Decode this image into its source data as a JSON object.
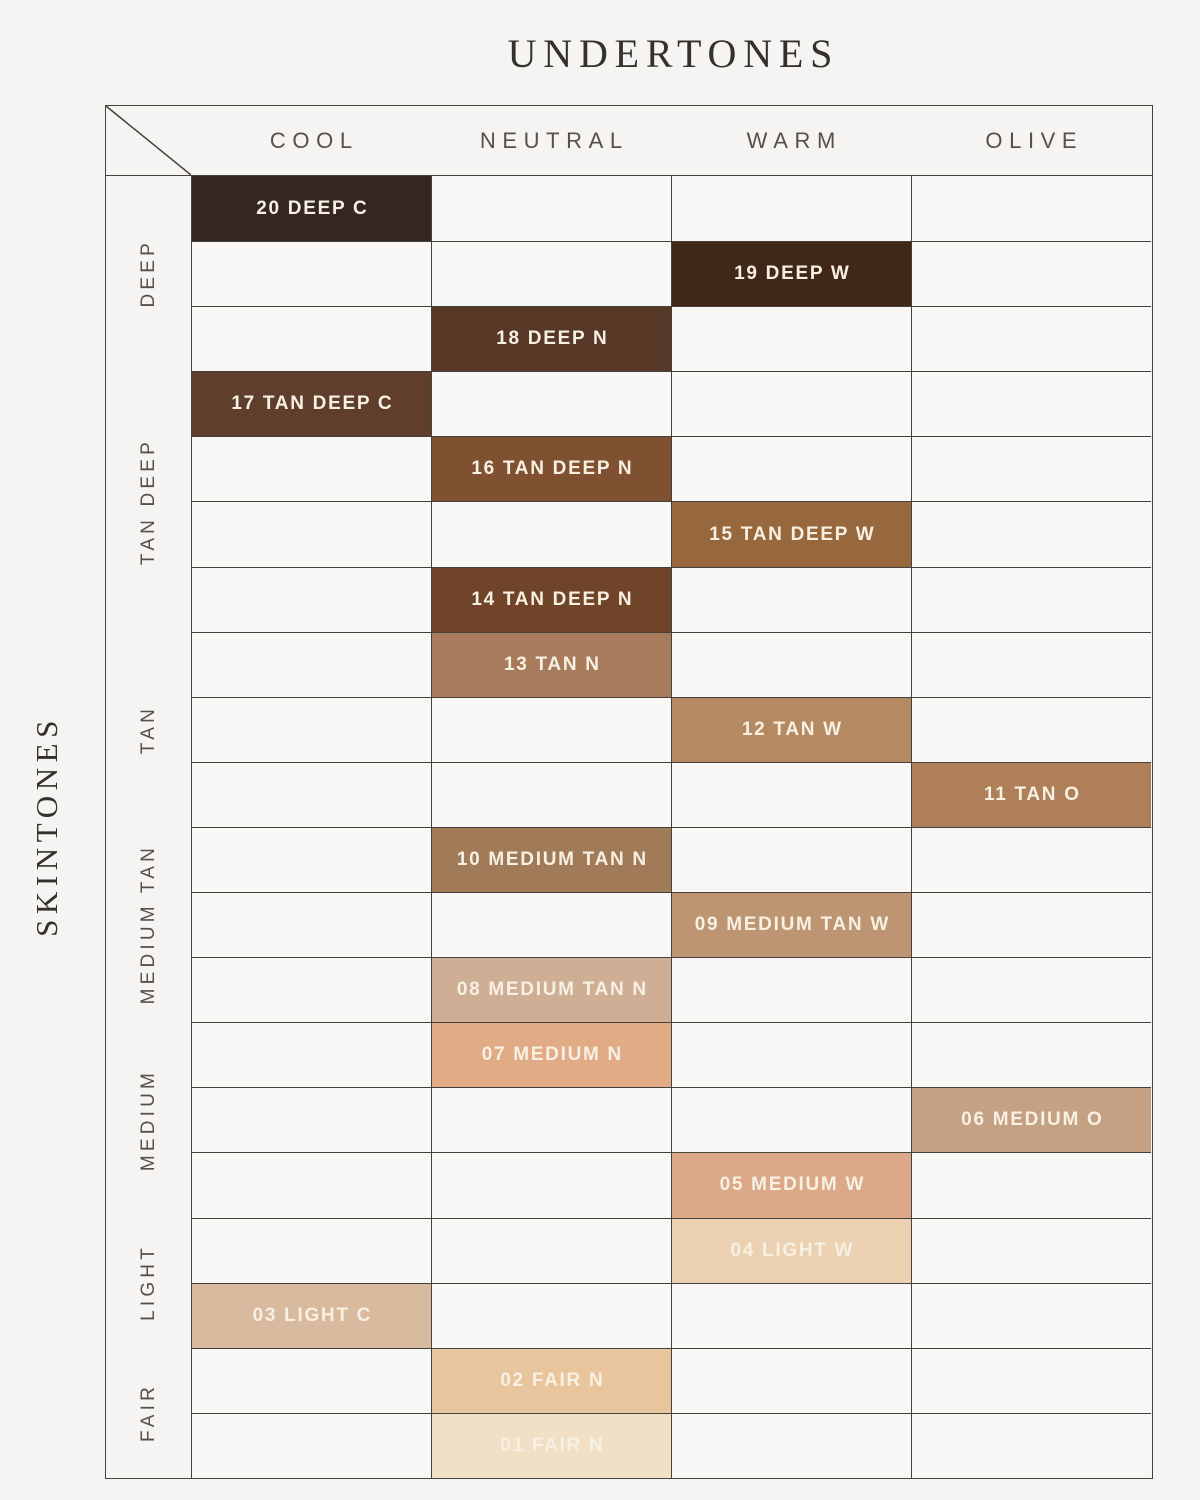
{
  "title": "UNDERTONES",
  "side_label": "SKINTONES",
  "undertone_columns": [
    "COOL",
    "NEUTRAL",
    "WARM",
    "OLIVE"
  ],
  "skintone_groups": [
    {
      "label": "DEEP",
      "rows": 3
    },
    {
      "label": "TAN DEEP",
      "rows": 4
    },
    {
      "label": "TAN",
      "rows": 3
    },
    {
      "label": "MEDIUM TAN",
      "rows": 3
    },
    {
      "label": "MEDIUM",
      "rows": 3
    },
    {
      "label": "LIGHT",
      "rows": 2
    },
    {
      "label": "FAIR",
      "rows": 2
    }
  ],
  "colors": {
    "page_background": "#f5f4f2",
    "empty_cell_background": "#f8f7f5",
    "grid_line": "#45413d",
    "header_text": "#575049",
    "title_text": "#34302b",
    "swatch_label_text": "#f7f0e3"
  },
  "chart_data": {
    "type": "heatmap",
    "title": "UNDERTONES",
    "xlabel": "UNDERTONES",
    "ylabel": "SKINTONES",
    "x_categories": [
      "COOL",
      "NEUTRAL",
      "WARM",
      "OLIVE"
    ],
    "y_categories": [
      "DEEP",
      "TAN DEEP",
      "TAN",
      "MEDIUM TAN",
      "MEDIUM",
      "LIGHT",
      "FAIR"
    ],
    "shades": [
      {
        "shade": "20 DEEP C",
        "skintone": "DEEP",
        "undertone": "COOL",
        "color": "#342620"
      },
      {
        "shade": "19 DEEP W",
        "skintone": "DEEP",
        "undertone": "WARM",
        "color": "#3f2817"
      },
      {
        "shade": "18 DEEP N",
        "skintone": "DEEP",
        "undertone": "NEUTRAL",
        "color": "#573827"
      },
      {
        "shade": "17 TAN DEEP C",
        "skintone": "TAN DEEP",
        "undertone": "COOL",
        "color": "#5f3f2c"
      },
      {
        "shade": "16 TAN DEEP N",
        "skintone": "TAN DEEP",
        "undertone": "NEUTRAL",
        "color": "#7f5130"
      },
      {
        "shade": "15 TAN DEEP W",
        "skintone": "TAN DEEP",
        "undertone": "WARM",
        "color": "#97673d"
      },
      {
        "shade": "14 TAN DEEP N",
        "skintone": "TAN DEEP",
        "undertone": "NEUTRAL",
        "color": "#6f4428"
      },
      {
        "shade": "13 TAN N",
        "skintone": "TAN",
        "undertone": "NEUTRAL",
        "color": "#a87b5c"
      },
      {
        "shade": "12 TAN W",
        "skintone": "TAN",
        "undertone": "WARM",
        "color": "#b58a62"
      },
      {
        "shade": "11 TAN O",
        "skintone": "TAN",
        "undertone": "OLIVE",
        "color": "#ae7f58"
      },
      {
        "shade": "10 MEDIUM TAN N",
        "skintone": "MEDIUM TAN",
        "undertone": "NEUTRAL",
        "color": "#a17a58"
      },
      {
        "shade": "09 MEDIUM TAN W",
        "skintone": "MEDIUM TAN",
        "undertone": "WARM",
        "color": "#bd9573"
      },
      {
        "shade": "08 MEDIUM TAN N",
        "skintone": "MEDIUM TAN",
        "undertone": "NEUTRAL",
        "color": "#cfae96"
      },
      {
        "shade": "07 MEDIUM N",
        "skintone": "MEDIUM",
        "undertone": "NEUTRAL",
        "color": "#e0ab85"
      },
      {
        "shade": "06 MEDIUM O",
        "skintone": "MEDIUM",
        "undertone": "OLIVE",
        "color": "#c5a183"
      },
      {
        "shade": "05 MEDIUM W",
        "skintone": "MEDIUM",
        "undertone": "WARM",
        "color": "#dba987"
      },
      {
        "shade": "04 LIGHT W",
        "skintone": "LIGHT",
        "undertone": "WARM",
        "color": "#ebd1b1"
      },
      {
        "shade": "03 LIGHT C",
        "skintone": "LIGHT",
        "undertone": "COOL",
        "color": "#d8ba9e"
      },
      {
        "shade": "02 FAIR N",
        "skintone": "FAIR",
        "undertone": "NEUTRAL",
        "color": "#e9c59d"
      },
      {
        "shade": "01 FAIR N",
        "skintone": "FAIR",
        "undertone": "NEUTRAL",
        "color": "#f1e0c5"
      }
    ]
  }
}
